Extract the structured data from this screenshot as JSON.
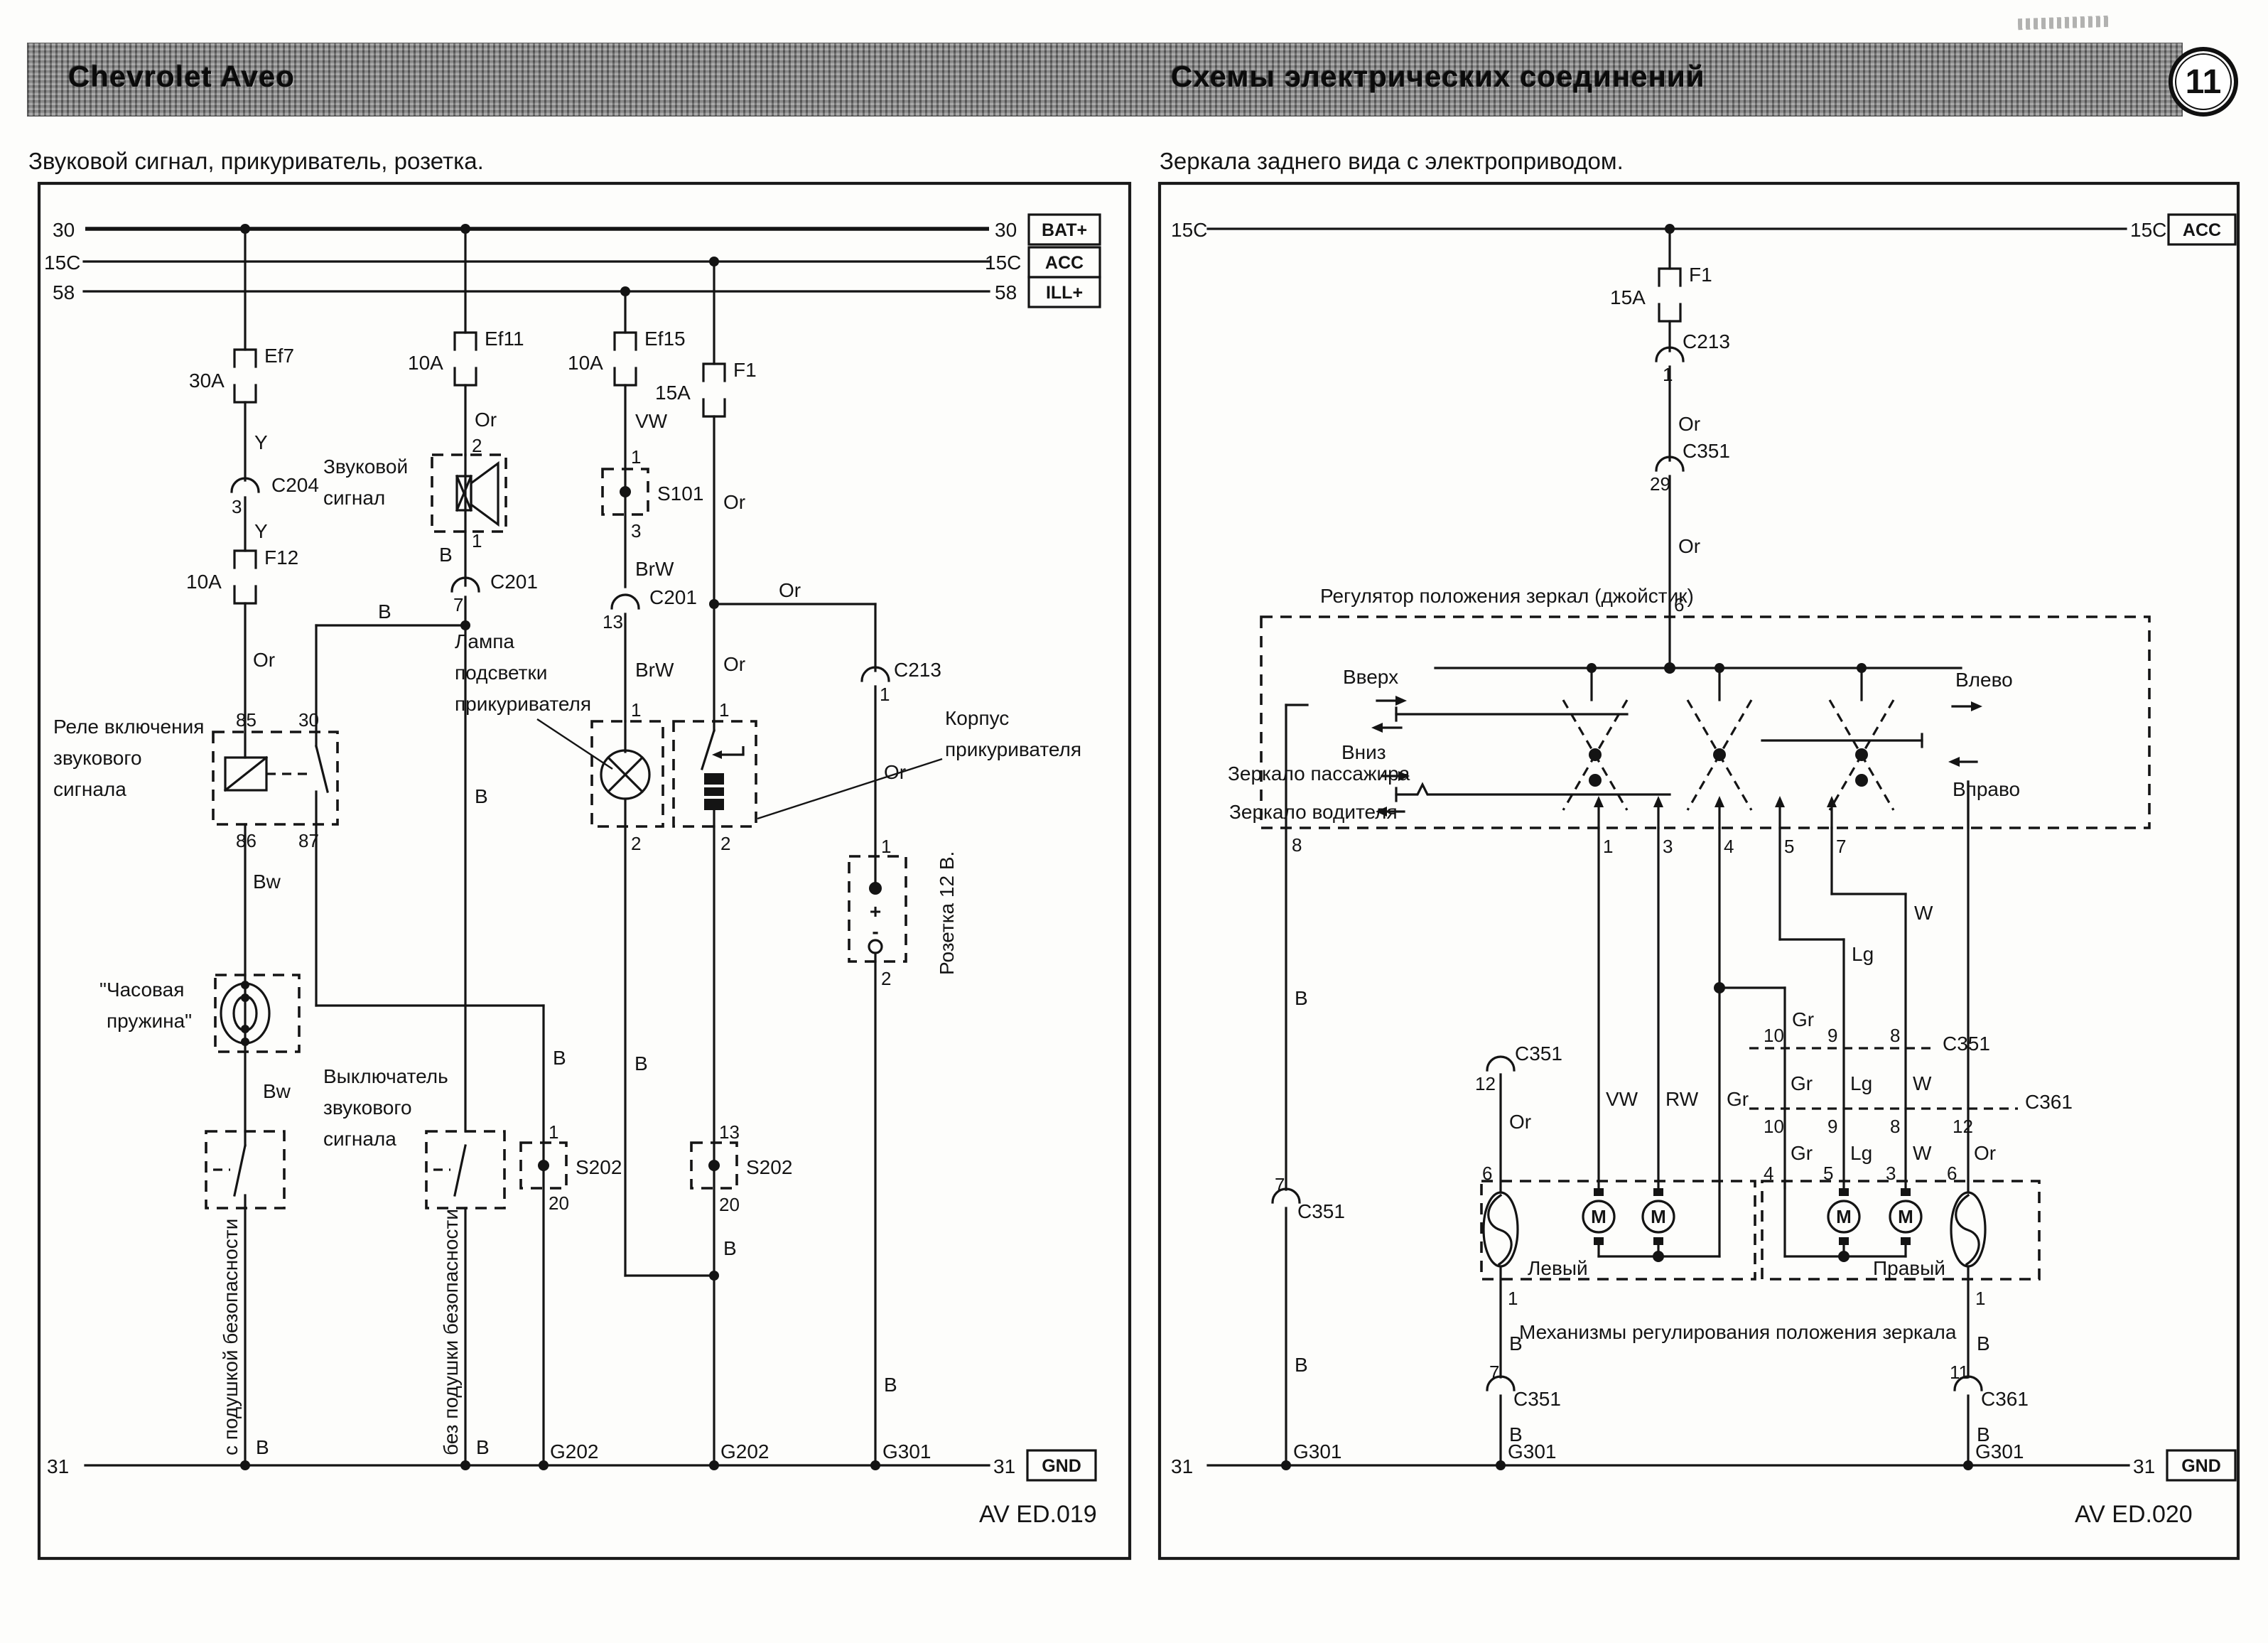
{
  "header": {
    "brand": "Chevrolet Aveo",
    "title": "Схемы электрических соединений",
    "page": "11"
  },
  "left": {
    "title": "Звуковой сигнал, прикуриватель, розетка.",
    "caption": "AV ED.019",
    "labels": {
      "relay1": "Реле включения",
      "relay2": "звукового",
      "relay3": "сигнала",
      "horn1": "Звуковой",
      "horn2": "сигнал",
      "spring1": "\"Часовая",
      "spring2": "пружина\"",
      "switch1": "Выключатель",
      "switch2": "звукового",
      "switch3": "сигнала",
      "lamp1": "Лампа",
      "lamp2": "подсветки",
      "lamp3": "прикуривателя",
      "housing1": "Корпус",
      "housing2": "прикуривателя",
      "socket": "Розетка 12 В.",
      "with_airbag": "с подушкой безопасности",
      "without_airbag": "без подушки безопасности",
      "plus": "+",
      "minus": "-"
    }
  },
  "right": {
    "title": "Зеркала заднего вида с электроприводом.",
    "caption": "AV ED.020",
    "labels": {
      "joystick": "Регулятор положения зеркал (джойстик)",
      "up": "Вверх",
      "down": "Вниз",
      "lefts": "Влево",
      "rights": "Вправо",
      "mirror_pass": "Зеркало пассажира",
      "mirror_drv": "Зеркало водителя",
      "left_mech": "Левый",
      "right_mech": "Правый",
      "mech": "Механизмы регулирования положения зеркала",
      "motor": "M"
    }
  },
  "bus": {
    "b30": "30",
    "b15c": "15C",
    "b58": "58",
    "b31": "31",
    "bat": "BAT+",
    "acc": "ACC",
    "ill": "ILL+",
    "gnd": "GND"
  },
  "w": {
    "B": "B",
    "Bw": "Bw",
    "BrW": "BrW",
    "Y": "Y",
    "Or": "Or",
    "VW": "VW",
    "RW": "RW",
    "Gr": "Gr",
    "Lg": "Lg",
    "W": "W"
  },
  "p": {
    "n1": "1",
    "n2": "2",
    "n3": "3",
    "n4": "4",
    "n5": "5",
    "n6": "6",
    "n7": "7",
    "n8": "8",
    "n9": "9",
    "n10": "10",
    "n11": "11",
    "n12": "12",
    "n13": "13",
    "n20": "20",
    "n29": "29",
    "n30": "30",
    "n85": "85",
    "n86": "86",
    "n87": "87"
  },
  "f": {
    "ef7": "Ef7",
    "ef11": "Ef11",
    "ef15": "Ef15",
    "f12": "F12",
    "f1": "F1",
    "a30": "30A",
    "a10": "10A",
    "a15": "15A"
  },
  "c": {
    "c201": "C201",
    "c204": "C204",
    "c213": "C213",
    "c351": "C351",
    "c361": "C361",
    "s101": "S101",
    "s202": "S202"
  },
  "g": {
    "g202": "G202",
    "g301": "G301"
  }
}
